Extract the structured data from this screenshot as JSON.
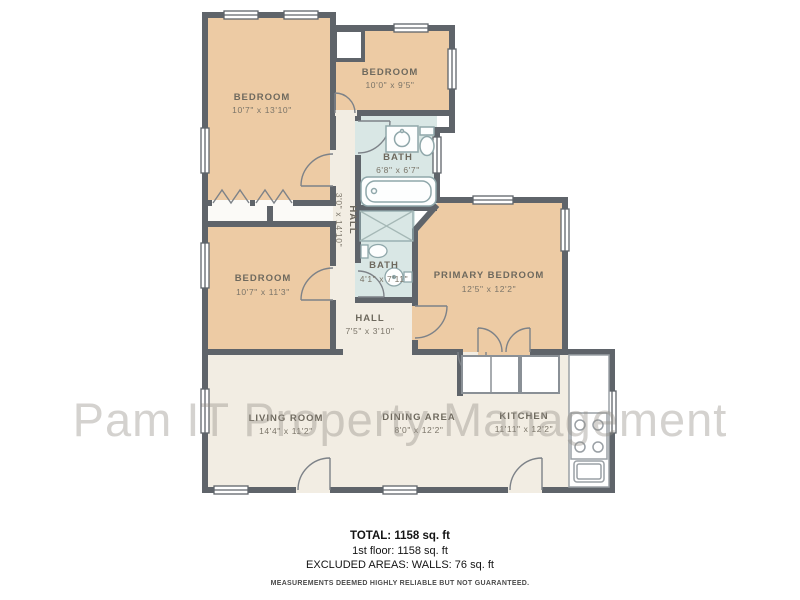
{
  "watermark": "Pam IT Property Management",
  "colors": {
    "bedroom_fill": "#edcba4",
    "floor_fill": "#f2ede3",
    "bath_fill": "#d9e7e5",
    "wall": "#5f646a",
    "label_text": "#6e695e"
  },
  "rooms": [
    {
      "id": "bedroom-1",
      "name": "BEDROOM",
      "dims": "10'7\" x 13'10\""
    },
    {
      "id": "bedroom-2",
      "name": "BEDROOM",
      "dims": "10'0\" x 9'5\""
    },
    {
      "id": "bath-1",
      "name": "BATH",
      "dims": "6'8\" x 6'7\""
    },
    {
      "id": "hall-1",
      "name": "HALL",
      "dims": "3'0\" x 14'10\""
    },
    {
      "id": "bedroom-3",
      "name": "BEDROOM",
      "dims": "10'7\" x 11'3\""
    },
    {
      "id": "bath-2",
      "name": "BATH",
      "dims": "4'1\" x 7'11\""
    },
    {
      "id": "primary-bedroom",
      "name": "PRIMARY BEDROOM",
      "dims": "12'5\" x 12'2\""
    },
    {
      "id": "hall-2",
      "name": "HALL",
      "dims": "7'5\" x 3'10\""
    },
    {
      "id": "living-room",
      "name": "LIVING ROOM",
      "dims": "14'4\" x 11'2\""
    },
    {
      "id": "dining-area",
      "name": "DINING AREA",
      "dims": "8'0\" x 12'2\""
    },
    {
      "id": "kitchen",
      "name": "KITCHEN",
      "dims": "11'11\" x 12'2\""
    }
  ],
  "footer": {
    "total": "TOTAL: 1158 sq. ft",
    "floor": "1st floor: 1158 sq. ft",
    "excluded": "EXCLUDED AREAS: WALLS: 76 sq. ft",
    "disclaimer": "MEASUREMENTS DEEMED HIGHLY RELIABLE BUT NOT GUARANTEED."
  }
}
